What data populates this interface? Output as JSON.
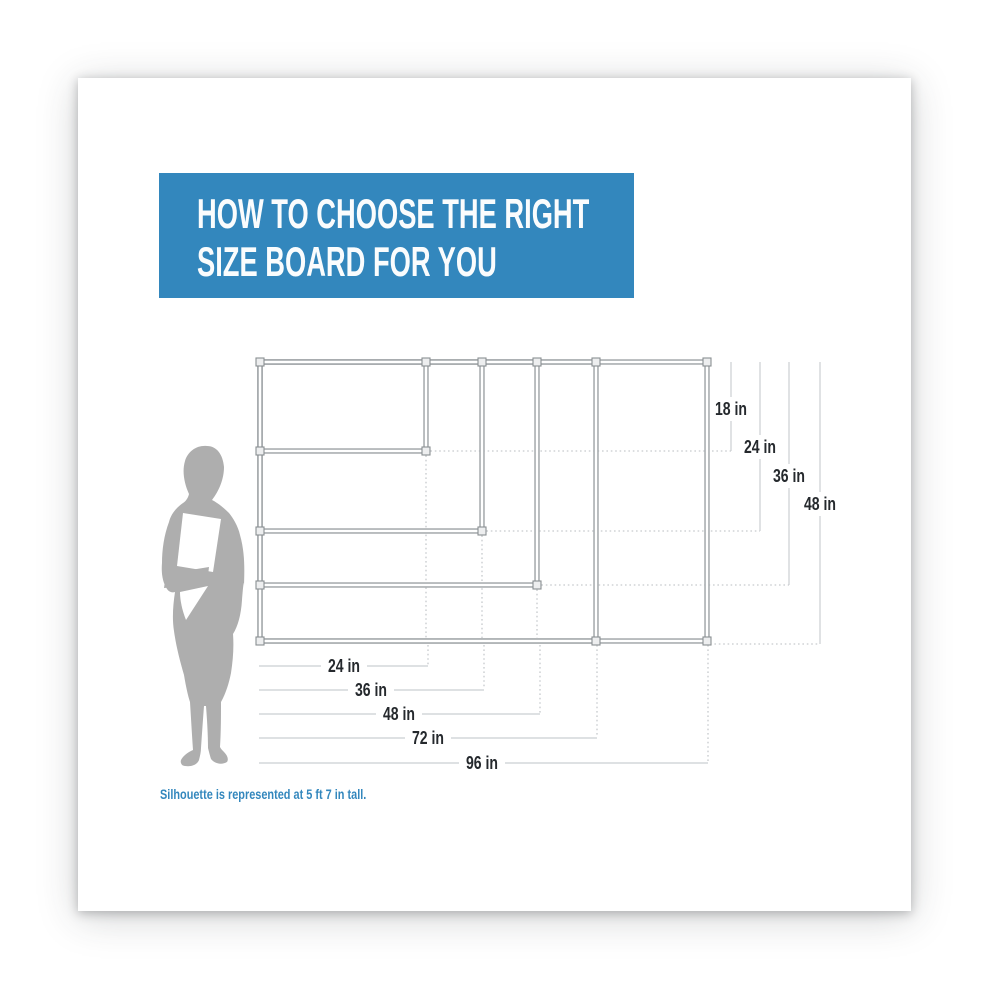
{
  "header": {
    "title_line1": "HOW TO CHOOSE THE RIGHT",
    "title_line2": "SIZE BOARD FOR YOU",
    "background_color": "#3387BD",
    "text_color": "#FFFFFF"
  },
  "diagram": {
    "type": "nested-board-size-comparison",
    "board_sizes_in": [
      {
        "width": 24,
        "height": 18
      },
      {
        "width": 36,
        "height": 24
      },
      {
        "width": 48,
        "height": 36
      },
      {
        "width": 72,
        "height": 48
      },
      {
        "width": 96,
        "height": 48
      }
    ],
    "height_labels": [
      "18 in",
      "24 in",
      "36 in",
      "48 in"
    ],
    "width_labels": [
      "24 in",
      "36 in",
      "48 in",
      "72 in",
      "96 in"
    ],
    "frame_color": "#A7ABAE",
    "guide_line_color": "#C9CDD0",
    "label_color": "#25292D",
    "silhouette_color": "#AEAEAE"
  },
  "caption": {
    "text": "Silhouette is represented at 5 ft 7 in tall.",
    "color": "#3387BD"
  }
}
